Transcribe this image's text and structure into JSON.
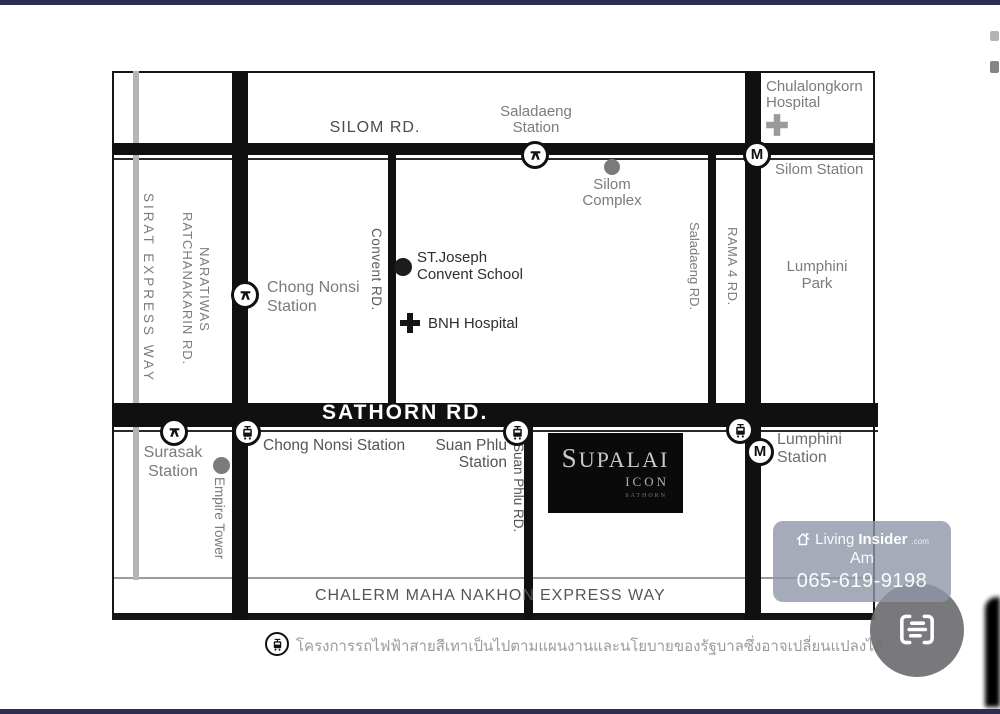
{
  "chrome": {
    "top_bar_color": "#2e2e55",
    "bottom_bar_color": "#2e2e55"
  },
  "map": {
    "road_labels": {
      "silom": "SILOM RD.",
      "sathorn": "SATHORN RD.",
      "sirat": "SIRAT EXPRESS WAY",
      "naratiwas_line1": "NARATIWAS",
      "naratiwas_line2": "RATCHANAKARIN RD.",
      "convent": "Convent RD.",
      "saladaeng": "Saladaeng RD.",
      "rama4": "RAMA 4 RD.",
      "suan_phlu": "Suan Phlu RD.",
      "chalerm_part1": "CHALERM MAHA NAKHON",
      "chalerm_part2": "EXPRESS WAY"
    },
    "stations": {
      "mrt_letter": "M",
      "saladaeng": {
        "line1": "Saladaeng",
        "line2": "Station"
      },
      "silom": "Silom Station",
      "chong_nonsi_bts": {
        "line1": "Chong Nonsi",
        "line2": "Station"
      },
      "surasak": {
        "line1": "Surasak",
        "line2": "Station"
      },
      "chong_nonsi_gray": "Chong Nonsi Station",
      "suan_phlu": {
        "line1": "Suan Phlu",
        "line2": "Station"
      },
      "lumphini": {
        "line1": "Lumphini",
        "line2": "Station"
      }
    },
    "places": {
      "chulalongkorn": {
        "line1": "Chulalongkorn",
        "line2": "Hospital"
      },
      "silom_complex": {
        "line1": "Silom",
        "line2": "Complex"
      },
      "st_joseph": {
        "line1": "ST.Joseph",
        "line2": "Convent School"
      },
      "bnh": "BNH Hospital",
      "lumphini_park": {
        "line1": "Lumphini",
        "line2": "Park"
      },
      "empire_tower": "Empire Tower"
    },
    "logo": {
      "brand": "SUPALAI",
      "sub": "ICON",
      "sub2": "SATHORN"
    },
    "note_text": "โครงการรถไฟฟ้าสายสีเทาเป็นไปตามแผนงานและนโยบายของรัฐบาลซึ่งอาจเปลี่ยนแปลงได้"
  },
  "watermark": {
    "brand_light": "Living",
    "brand_bold": "Insider",
    "brand_suffix": ".com",
    "agent": "Am",
    "phone": "065-619-9198"
  },
  "icons": {
    "bts": "bts-logo-icon",
    "mrt": "mrt-m-icon",
    "grayline": "train-icon",
    "hospital": "cross-icon",
    "watermark": "house-icon",
    "chat": "chat-lines-icon"
  },
  "colors": {
    "road": "#101010",
    "gray_road": "#b5b5b5",
    "label_gray": "#7b7b7b",
    "label_dark": "#2e2e2e",
    "watermark_bg": "rgba(142,150,168,0.80)",
    "chat_bg": "rgba(110,110,114,0.92)",
    "edge_bar": "#2e2e55"
  }
}
